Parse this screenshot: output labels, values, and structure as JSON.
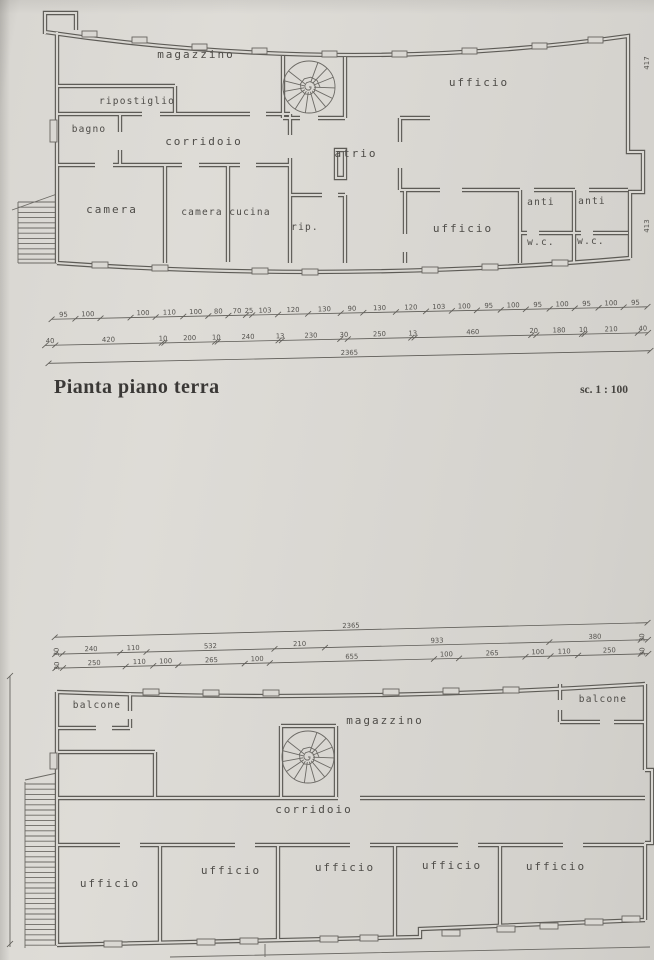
{
  "document": {
    "title": "Pianta piano terra",
    "scale": "sc. 1 : 100"
  },
  "colors": {
    "paper": "#d9d7d2",
    "ink": "#5d5b56",
    "text": "#4e4c48"
  },
  "plan_ground": {
    "rooms": [
      "magazzino",
      "ripostiglio",
      "bagno",
      "corridoio",
      "camera",
      "camera",
      "cucina",
      "atrio",
      "rip.",
      "ufficio",
      "ufficio",
      "anti",
      "anti",
      "w.c.",
      "w.c."
    ],
    "side_dims": [
      "417",
      "413"
    ]
  },
  "plan_first": {
    "rooms": [
      "balcone",
      "magazzino",
      "balcone",
      "corridoio",
      "ufficio",
      "ufficio",
      "ufficio",
      "ufficio",
      "ufficio"
    ]
  },
  "dimensions": [
    {
      "group": "dims-ground",
      "y": 313,
      "x0": 52,
      "x1": 648,
      "rot": false,
      "segments": [
        [
          95,
          "95"
        ],
        [
          100,
          "100"
        ],
        [
          120,
          ""
        ],
        [
          100,
          "100"
        ],
        [
          110,
          "110"
        ],
        [
          100,
          "100"
        ],
        [
          80,
          "80"
        ],
        [
          70,
          "70"
        ],
        [
          25,
          "25"
        ],
        [
          103,
          "103"
        ],
        [
          120,
          "120"
        ],
        [
          130,
          "130"
        ],
        [
          90,
          "90"
        ],
        [
          130,
          "130"
        ],
        [
          120,
          "120"
        ],
        [
          103,
          "103"
        ],
        [
          100,
          "100"
        ],
        [
          95,
          "95"
        ],
        [
          100,
          "100"
        ],
        [
          95,
          "95"
        ],
        [
          100,
          "100"
        ],
        [
          95,
          "95"
        ],
        [
          100,
          "100"
        ],
        [
          95,
          "95"
        ]
      ]
    },
    {
      "group": "dims-ground",
      "y": 339,
      "x0": 45,
      "x1": 648,
      "rot": false,
      "segments": [
        [
          40,
          "40"
        ],
        [
          420,
          "420"
        ],
        [
          10,
          "10"
        ],
        [
          200,
          "200"
        ],
        [
          10,
          "10"
        ],
        [
          240,
          "240"
        ],
        [
          13,
          "13"
        ],
        [
          230,
          "230"
        ],
        [
          30,
          "30"
        ],
        [
          250,
          "250"
        ],
        [
          13,
          "13"
        ],
        [
          460,
          "460"
        ],
        [
          20,
          "20"
        ],
        [
          180,
          "180"
        ],
        [
          10,
          "10"
        ],
        [
          210,
          "210"
        ],
        [
          40,
          "40"
        ]
      ]
    },
    {
      "group": "dims-ground",
      "y": 357,
      "x0": 48,
      "x1": 650,
      "rot": false,
      "segments": [
        [
          2365,
          "2365"
        ]
      ]
    },
    {
      "group": "dims-first",
      "y": 630,
      "x0": 55,
      "x1": 648,
      "rot": false,
      "segments": [
        [
          2365,
          "2365"
        ]
      ]
    },
    {
      "group": "dims-first",
      "y": 647,
      "x0": 55,
      "x1": 648,
      "rot": true,
      "segments": [
        [
          30,
          "30"
        ],
        [
          240,
          "240"
        ],
        [
          110,
          "110"
        ],
        [
          532,
          "532"
        ],
        [
          210,
          "210"
        ],
        [
          933,
          "933"
        ],
        [
          380,
          "380"
        ],
        [
          30,
          "30"
        ]
      ]
    },
    {
      "group": "dims-first",
      "y": 661,
      "x0": 55,
      "x1": 648,
      "rot": true,
      "segments": [
        [
          30,
          "30"
        ],
        [
          250,
          "250"
        ],
        [
          110,
          "110"
        ],
        [
          100,
          "100"
        ],
        [
          265,
          "265"
        ],
        [
          100,
          "100"
        ],
        [
          655,
          "655"
        ],
        [
          100,
          "100"
        ],
        [
          265,
          "265"
        ],
        [
          100,
          "100"
        ],
        [
          110,
          "110"
        ],
        [
          250,
          "250"
        ],
        [
          30,
          "30"
        ]
      ]
    }
  ]
}
